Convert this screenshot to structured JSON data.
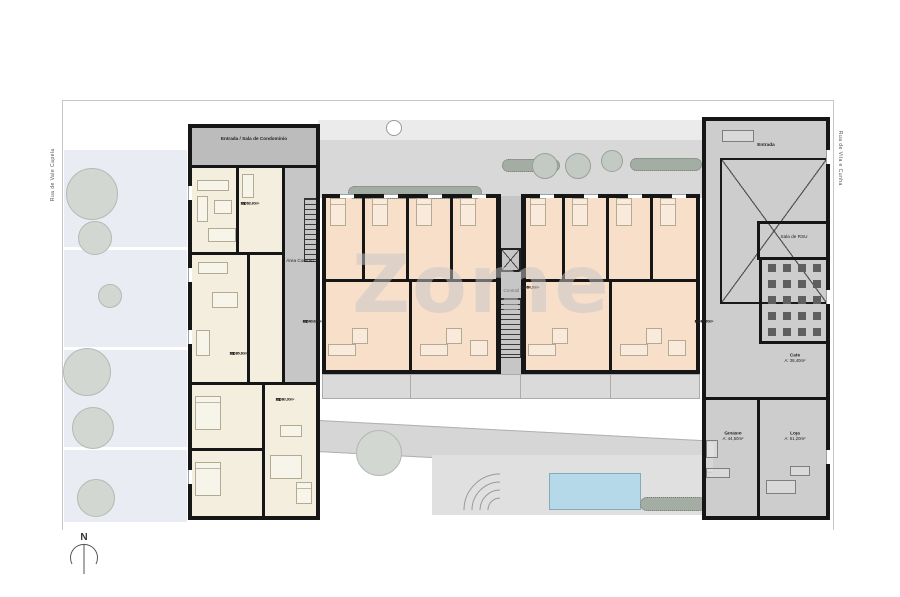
{
  "site": {
    "watermark": "Zome",
    "north_label": "N",
    "streets": {
      "left": "Rua de Vale Capela",
      "right": "Rua de Vila e Cunha"
    }
  },
  "left_building": {
    "hall_label": "Entrada / Sala de Condomínio",
    "corridor_label": "Área Comum"
  },
  "core": {
    "label": "Central"
  },
  "right_building": {
    "entrance_label": "Entrada",
    "rsu_label": "Sala de RSU",
    "cafe": {
      "name": "Café",
      "area": "A: 38,40m²"
    },
    "gym": {
      "name": "Ginásio",
      "area": "A: 44,50m²"
    },
    "shop": {
      "name": "Loja",
      "area": "A: 51,20m²"
    }
  },
  "units": [
    {
      "type": "T1",
      "code": "0001",
      "ab": "AB: 52,40m²",
      "ac": "AC: 58,20m²"
    },
    {
      "type": "T1",
      "code": "0002",
      "ab": "AB: 49,80m²",
      "ac": "AC: 55,60m²"
    },
    {
      "type": "T1",
      "code": "0003",
      "ab": "AB: 47,20m²",
      "ac": "AC: 53,00m²"
    },
    {
      "type": "T3",
      "code": "0004",
      "ab": "AB: 96,50m²",
      "ac": "AC: 104,30m²"
    },
    {
      "type": "T2",
      "code": "0005",
      "ab": "AB: 77,10m²",
      "ac": "AC: 84,90m²"
    },
    {
      "type": "T2",
      "code": "0006",
      "ab": "AB: 78,40m²",
      "ac": "AC: 86,20m²"
    }
  ],
  "colors": {
    "apartment_cream": "#f3eedd",
    "apartment_salmon": "#f7dfca",
    "common_gray": "#cdcdcd",
    "terrace_gray": "#d8d8d8",
    "pool_blue": "#b5d9e9",
    "wall_black": "#161616",
    "watermark_gray": "#c7c7c7"
  }
}
